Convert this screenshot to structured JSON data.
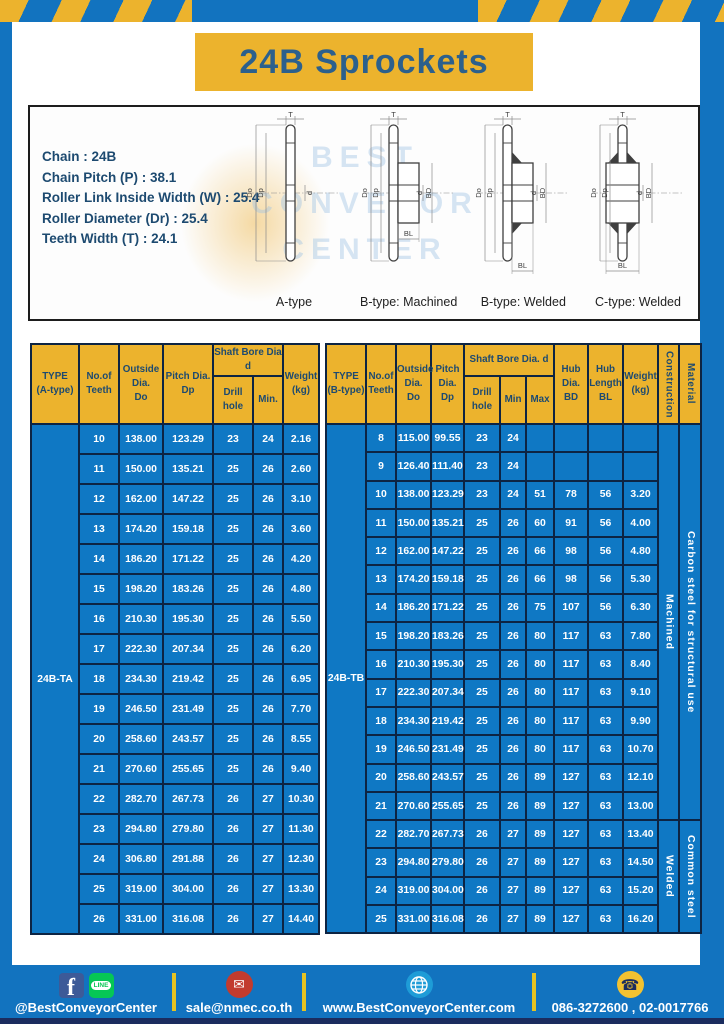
{
  "title": "24B Sprockets",
  "colors": {
    "frame_blue": "#1273bf",
    "accent_yellow": "#ecb32d",
    "table_cell_blue": "#0f78c4",
    "table_border_navy": "#0d2443",
    "header_text_navy": "#1d4a70",
    "title_text_blue": "#2c608c",
    "footer_strip_navy": "#1b2c5e",
    "facebook_blue": "#3d5a98",
    "line_green": "#06c755",
    "email_red": "#c23b2e",
    "globe_blue": "#1e9cd7",
    "phone_yellow": "#f2c231"
  },
  "spec_box": {
    "lines": [
      "Chain : 24B",
      "Chain Pitch (P) : 38.1",
      "Roller Link Inside Width (W) : 25.4",
      "Roller Diameter (Dr) : 25.4",
      "Teeth Width (T) : 24.1"
    ],
    "watermark_lines": [
      "BEST",
      "CONVEYOR",
      "CENTER"
    ],
    "diagrams": [
      {
        "caption": "A-type",
        "style": "plate",
        "dims": [
          "T",
          "Do",
          "Dp",
          "d",
          "",
          ""
        ]
      },
      {
        "caption": "B-type: Machined",
        "style": "hub",
        "dims": [
          "T",
          "Do",
          "Dp",
          "d",
          "BD",
          "BL"
        ]
      },
      {
        "caption": "B-type: Welded",
        "style": "hub-welded",
        "dims": [
          "T",
          "Do",
          "Dp",
          "d",
          "BD",
          "BL"
        ]
      },
      {
        "caption": "C-type: Welded",
        "style": "hub-welded-sym",
        "dims": [
          "T",
          "Do",
          "Dp",
          "d",
          "BD",
          "BL"
        ]
      }
    ]
  },
  "table_a": {
    "type_value": "24B-TA",
    "header": {
      "type": "TYPE\n(A-type)",
      "teeth": "No.of\nTeeth",
      "outside": "Outside\nDia.\nDo",
      "pitch": "Pitch Dia.\nDp",
      "shaft_group": "Shaft Bore Dia d",
      "drill": "Drill hole",
      "min": "Min.",
      "weight": "Weight\n(kg)"
    },
    "rows": [
      [
        "10",
        "138.00",
        "123.29",
        "23",
        "24",
        "2.16"
      ],
      [
        "11",
        "150.00",
        "135.21",
        "25",
        "26",
        "2.60"
      ],
      [
        "12",
        "162.00",
        "147.22",
        "25",
        "26",
        "3.10"
      ],
      [
        "13",
        "174.20",
        "159.18",
        "25",
        "26",
        "3.60"
      ],
      [
        "14",
        "186.20",
        "171.22",
        "25",
        "26",
        "4.20"
      ],
      [
        "15",
        "198.20",
        "183.26",
        "25",
        "26",
        "4.80"
      ],
      [
        "16",
        "210.30",
        "195.30",
        "25",
        "26",
        "5.50"
      ],
      [
        "17",
        "222.30",
        "207.34",
        "25",
        "26",
        "6.20"
      ],
      [
        "18",
        "234.30",
        "219.42",
        "25",
        "26",
        "6.95"
      ],
      [
        "19",
        "246.50",
        "231.49",
        "25",
        "26",
        "7.70"
      ],
      [
        "20",
        "258.60",
        "243.57",
        "25",
        "26",
        "8.55"
      ],
      [
        "21",
        "270.60",
        "255.65",
        "25",
        "26",
        "9.40"
      ],
      [
        "22",
        "282.70",
        "267.73",
        "26",
        "27",
        "10.30"
      ],
      [
        "23",
        "294.80",
        "279.80",
        "26",
        "27",
        "11.30"
      ],
      [
        "24",
        "306.80",
        "291.88",
        "26",
        "27",
        "12.30"
      ],
      [
        "25",
        "319.00",
        "304.00",
        "26",
        "27",
        "13.30"
      ],
      [
        "26",
        "331.00",
        "316.08",
        "26",
        "27",
        "14.40"
      ]
    ]
  },
  "table_b": {
    "type_value": "24B-TB",
    "header": {
      "type": "TYPE\n(B-type)",
      "teeth": "No.of\nTeeth",
      "outside": "Outside\nDia.\nDo",
      "pitch": "Pitch\nDia.\nDp",
      "shaft_group": "Shaft Bore Dia.  d",
      "drill": "Drill hole",
      "min": "Min",
      "max": "Max",
      "hub_dia": "Hub\nDia.\nBD",
      "hub_len": "Hub\nLength\nBL",
      "weight": "Weight\n(kg)",
      "construction": "Construction",
      "material": "Material"
    },
    "rows": [
      [
        "8",
        "115.00",
        "99.55",
        "23",
        "24",
        "",
        "",
        "",
        ""
      ],
      [
        "9",
        "126.40",
        "111.40",
        "23",
        "24",
        "",
        "",
        "",
        ""
      ],
      [
        "10",
        "138.00",
        "123.29",
        "23",
        "24",
        "51",
        "78",
        "56",
        "3.20"
      ],
      [
        "11",
        "150.00",
        "135.21",
        "25",
        "26",
        "60",
        "91",
        "56",
        "4.00"
      ],
      [
        "12",
        "162.00",
        "147.22",
        "25",
        "26",
        "66",
        "98",
        "56",
        "4.80"
      ],
      [
        "13",
        "174.20",
        "159.18",
        "25",
        "26",
        "66",
        "98",
        "56",
        "5.30"
      ],
      [
        "14",
        "186.20",
        "171.22",
        "25",
        "26",
        "75",
        "107",
        "56",
        "6.30"
      ],
      [
        "15",
        "198.20",
        "183.26",
        "25",
        "26",
        "80",
        "117",
        "63",
        "7.80"
      ],
      [
        "16",
        "210.30",
        "195.30",
        "25",
        "26",
        "80",
        "117",
        "63",
        "8.40"
      ],
      [
        "17",
        "222.30",
        "207.34",
        "25",
        "26",
        "80",
        "117",
        "63",
        "9.10"
      ],
      [
        "18",
        "234.30",
        "219.42",
        "25",
        "26",
        "80",
        "117",
        "63",
        "9.90"
      ],
      [
        "19",
        "246.50",
        "231.49",
        "25",
        "26",
        "80",
        "117",
        "63",
        "10.70"
      ],
      [
        "20",
        "258.60",
        "243.57",
        "25",
        "26",
        "89",
        "127",
        "63",
        "12.10"
      ],
      [
        "21",
        "270.60",
        "255.65",
        "25",
        "26",
        "89",
        "127",
        "63",
        "13.00"
      ],
      [
        "22",
        "282.70",
        "267.73",
        "26",
        "27",
        "89",
        "127",
        "63",
        "13.40"
      ],
      [
        "23",
        "294.80",
        "279.80",
        "26",
        "27",
        "89",
        "127",
        "63",
        "14.50"
      ],
      [
        "24",
        "319.00",
        "304.00",
        "26",
        "27",
        "89",
        "127",
        "63",
        "15.20"
      ],
      [
        "25",
        "331.00",
        "316.08",
        "26",
        "27",
        "89",
        "127",
        "63",
        "16.20"
      ]
    ],
    "construction_groups": [
      {
        "label": "Machined",
        "span": 14
      },
      {
        "label": "Welded",
        "span": 4
      }
    ],
    "material_groups": [
      {
        "label": "Carbon  steel  for  structural use",
        "span": 14
      },
      {
        "label": "Common steel",
        "span": 4
      }
    ]
  },
  "footer": {
    "social_handle": "@BestConveyorCenter",
    "email": "sale@nmec.co.th",
    "website": "www.BestConveyorCenter.com",
    "phone": "086-3272600 , 02-0017766",
    "icons_text": {
      "facebook": "f",
      "line": "LINE"
    },
    "icon_glyphs": {
      "email": "✉",
      "phone": "☎"
    }
  }
}
